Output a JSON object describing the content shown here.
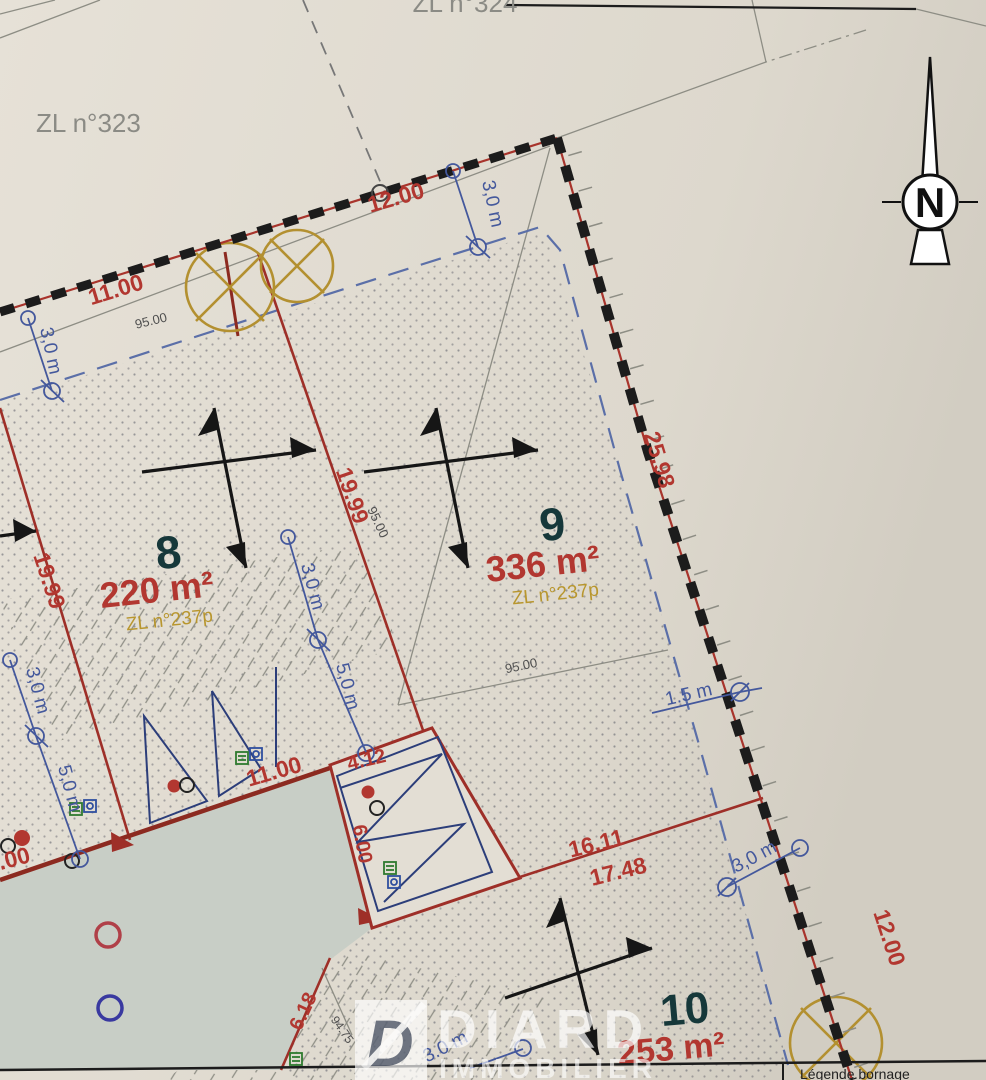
{
  "plan": {
    "neighbors": {
      "left": "ZL n°323",
      "top": "ZL n°324"
    },
    "compass": {
      "north": "N"
    },
    "parcels": [
      {
        "number": "8",
        "area": "220 m²",
        "cadastre": "ZL n°237p"
      },
      {
        "number": "9",
        "area": "336 m²",
        "cadastre": "ZL n°237p"
      },
      {
        "number": "10",
        "area": "253 m²"
      }
    ],
    "boundary_dimensions": {
      "top": "12.00",
      "top_left": "11.00",
      "left": "19.99",
      "middle": "19.99",
      "right": "25.98",
      "bottom_right": "12.00",
      "lower_a": "16.11",
      "lower_b": "17.48",
      "lower_left": "11.00",
      "garage_a": "4.12",
      "garage_b": "6.00",
      "road": "6.18",
      "left_edge": ".00"
    },
    "setback_dimensions": {
      "top": "3,0 m",
      "left": "3,0 m",
      "left_lower": "3,0 m",
      "left_depth": "5,0 m",
      "mid": "3,0 m",
      "mid_depth": "5,0 m",
      "right": "1.5 m",
      "bottom_right": "3,0 m",
      "bottom": "3.0 m"
    },
    "levels": {
      "a": "95.00",
      "b": "95.00",
      "c": "95.00",
      "d": "94.75"
    },
    "legend": {
      "title": "Légende bornage"
    },
    "watermark": {
      "initial": "D",
      "line1": "DIARD",
      "line2": "IMMOBILIER"
    }
  },
  "colors": {
    "paper": "#e3ded4",
    "paper_dark": "#d6d1c6",
    "road": "#c8cec6",
    "ink_black": "#1c1c1c",
    "boundary_red": "#a8342c",
    "division_red": "#9e2f28",
    "dark_red": "#8c2a20",
    "dim_red": "#b23730",
    "blue": "#44589c",
    "blue_dash": "#5b6fa8",
    "gold": "#b39030",
    "gold_text": "#b8962e",
    "number_dark": "#16383a",
    "gray_text": "#8b8b85",
    "level_gray": "#4f4f4f",
    "hatch_gray": "#8f8f86",
    "dot": "#4e4f5e"
  }
}
